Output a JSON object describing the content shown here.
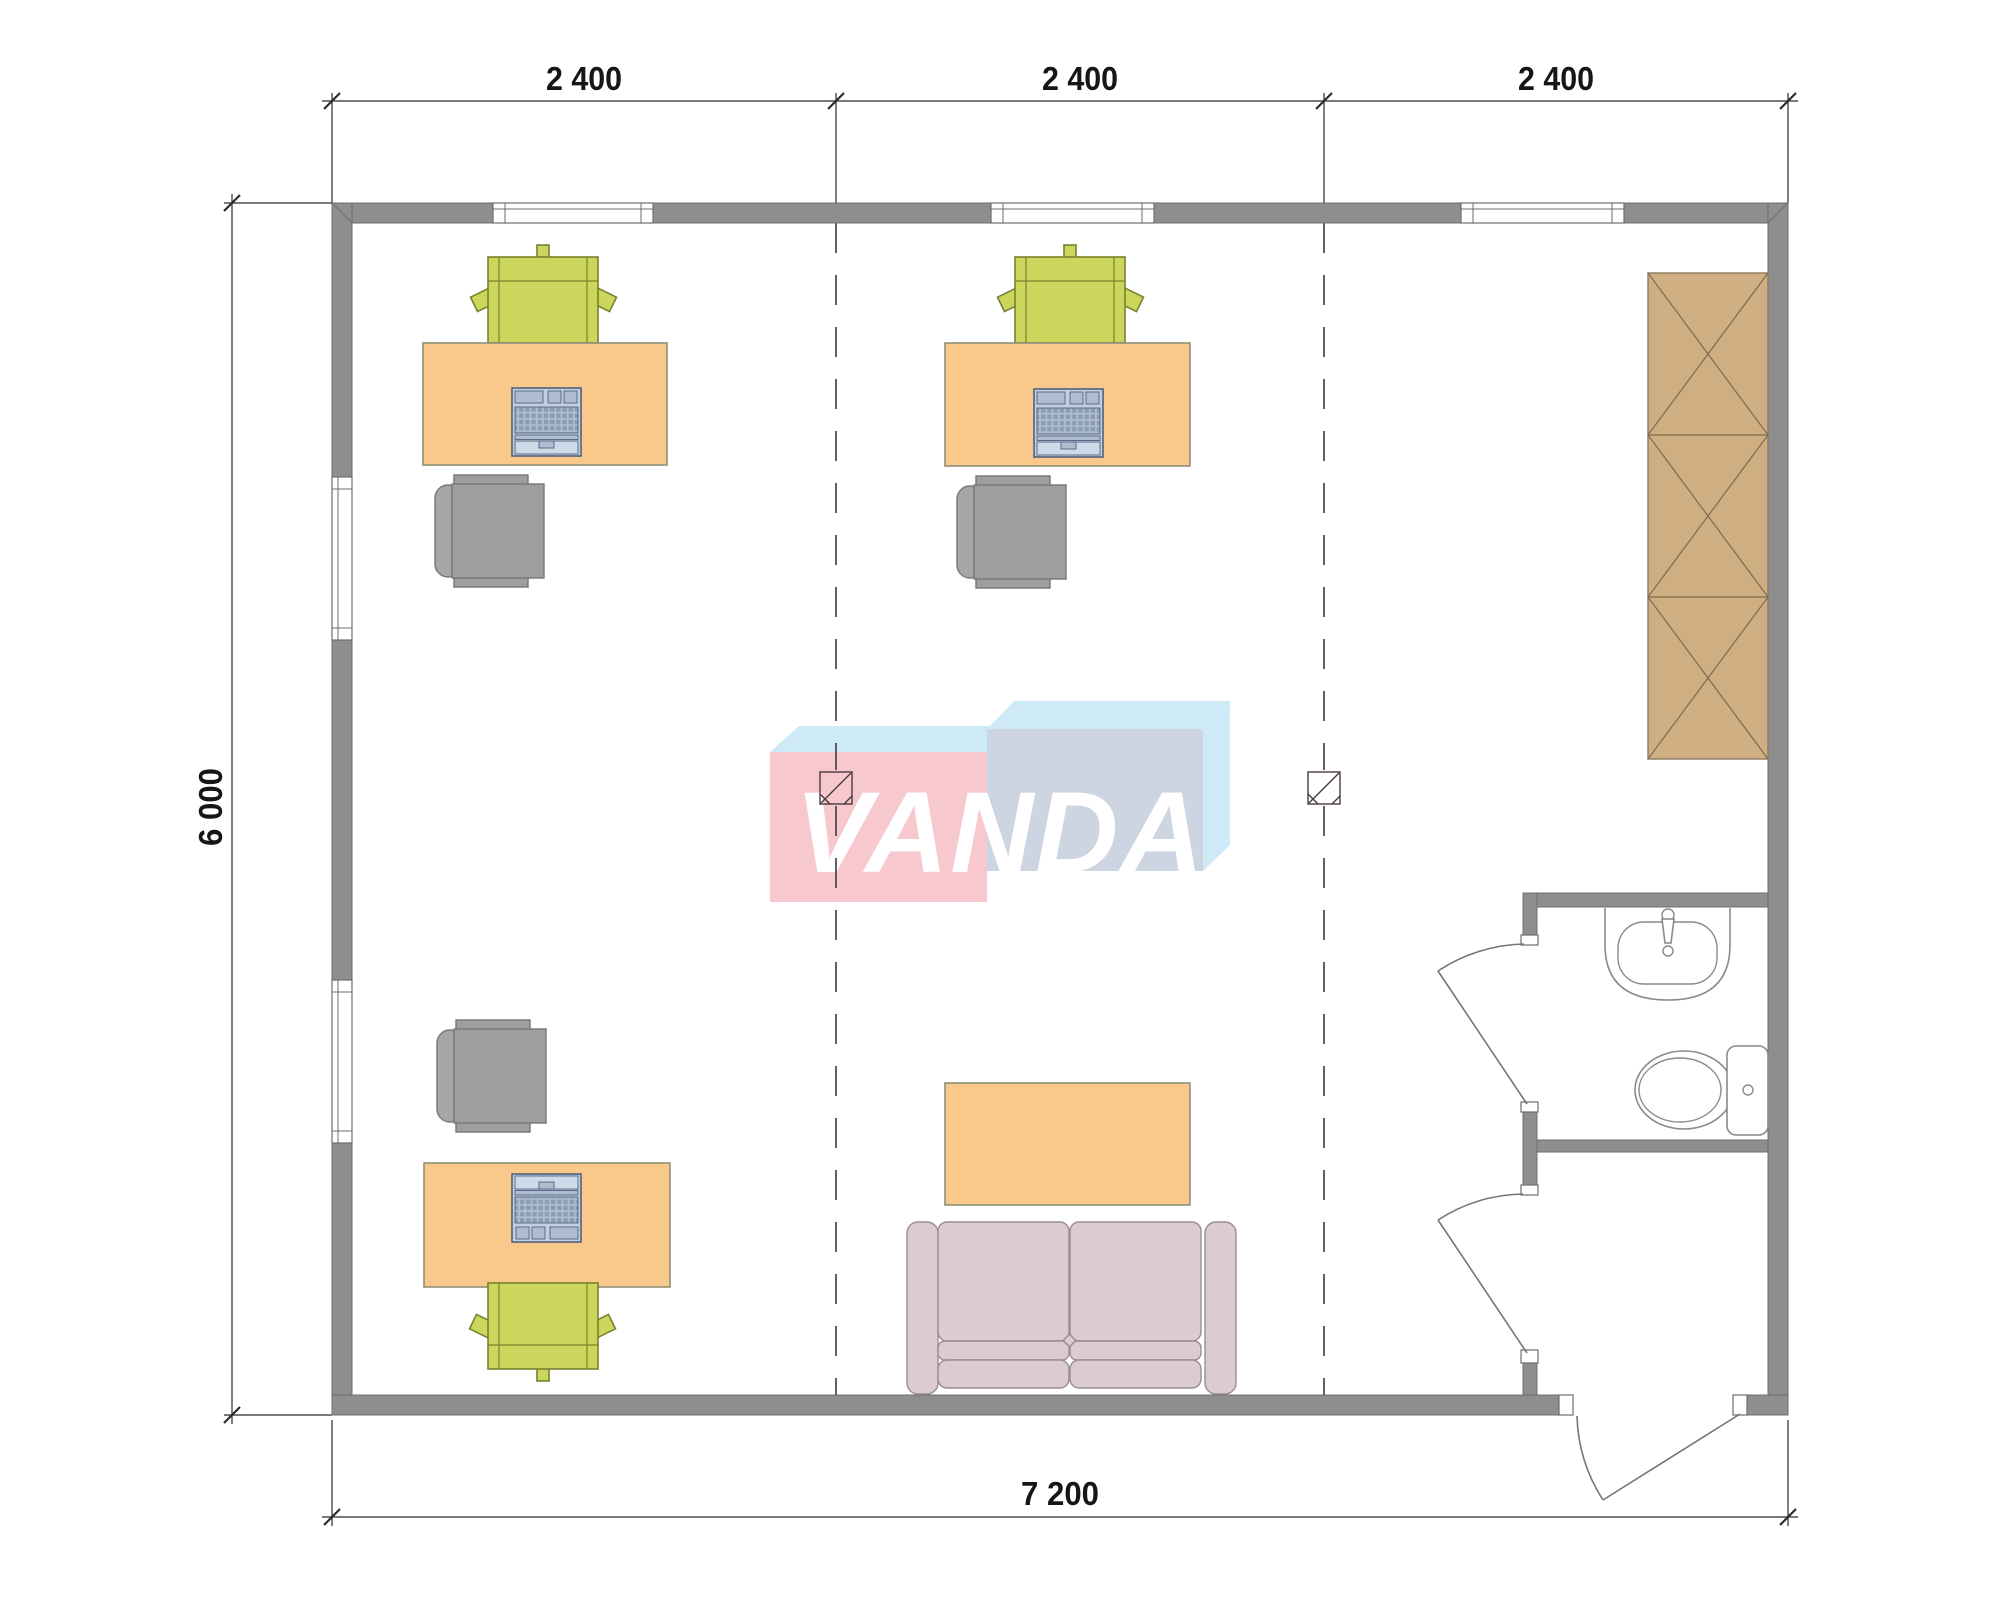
{
  "drawing": {
    "kind": "office floor plan",
    "brand": {
      "text": "VANDA"
    },
    "dimensions": {
      "top": [
        "2 400",
        "2 400",
        "2 400"
      ],
      "left": "6 000",
      "bottom": "7 200"
    },
    "furniture_items": [
      "desk",
      "laptop",
      "visitor-chair",
      "office-chair",
      "sofa",
      "coffee-table",
      "wardrobe",
      "sink",
      "toilet"
    ],
    "counts": {
      "desks": 3,
      "laptops": 3,
      "visitor_chairs": 3,
      "office_chairs": 3,
      "sofas": 1,
      "coffee_tables": 1,
      "wardrobes": 1,
      "sinks": 1,
      "toilets": 1,
      "windows_top": 3,
      "windows_left": 2,
      "doors": 3
    }
  },
  "colors": {
    "wall": "#8e8e8e",
    "desk": "#f9c88b",
    "chair_green": "#ccd65c",
    "chair_office": "#9e9e9e",
    "sofa": "#dccbd1",
    "wardrobe": "#cfae82",
    "logo_pink": "#f7c8ce",
    "logo_sky": "#cdeaf6",
    "logo_blue": "#ccd5e1"
  }
}
